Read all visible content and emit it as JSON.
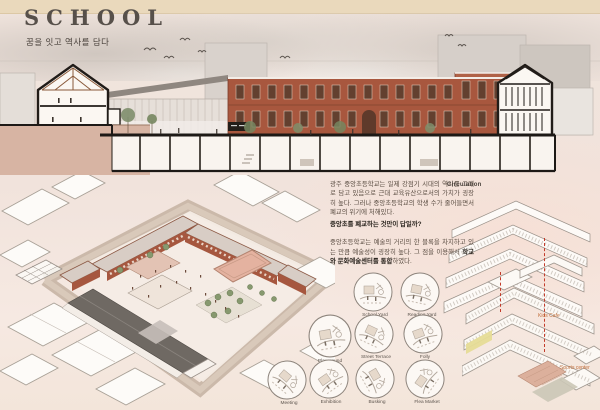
{
  "header": {
    "title": "SCHOOL",
    "subtitle": "꿈을 잇고 역사를 담다"
  },
  "intro": {
    "para1": "광주 중앙초등학교는 일제 강점기 시대의 역사를 그대로 담고 있음으로 근대 교육유산으로서의 가치가 굉장히 높다. 그러나 중앙초등학교의 학생 수가 줄어들면서 폐교의 위기에 처해있다.",
    "question": "중앙초를 폐교하는 것만이 답일까?",
    "para2_lead": "중앙초등학교는 예술의 거리의 한 블록을 차지하고 있는 만큼 예술성이 굉장히 높다. 그 점을 이용해서 ",
    "para2_bold": "학교와 문화예술센터를 통합",
    "para2_tail": "하였다."
  },
  "circulation": {
    "title": "Circulation"
  },
  "program": {
    "kids_cafe": "Kids Cafe",
    "sports_center": "Sports center"
  },
  "vignettes": [
    {
      "label": "School Yard"
    },
    {
      "label": "Reading Yard"
    },
    {
      "label": "Playground"
    },
    {
      "label": "Street Terrace"
    },
    {
      "label": "Folly"
    },
    {
      "label": "Meeting"
    },
    {
      "label": "Exhibition"
    },
    {
      "label": "Busking"
    },
    {
      "label": "Flea Market"
    }
  ],
  "colors": {
    "cream_band": "#ead9bc",
    "background": "#f2e5de",
    "brick": "#a8573e",
    "roof_dark": "#6f6963",
    "court_pink": "#e4b2a0",
    "highlight_yellow": "#e6dc96",
    "tree_green": "#87996f",
    "accent_dashed_red": "#c33b2a",
    "program_label_orange": "#c2703d",
    "ink": "#4a423c"
  }
}
